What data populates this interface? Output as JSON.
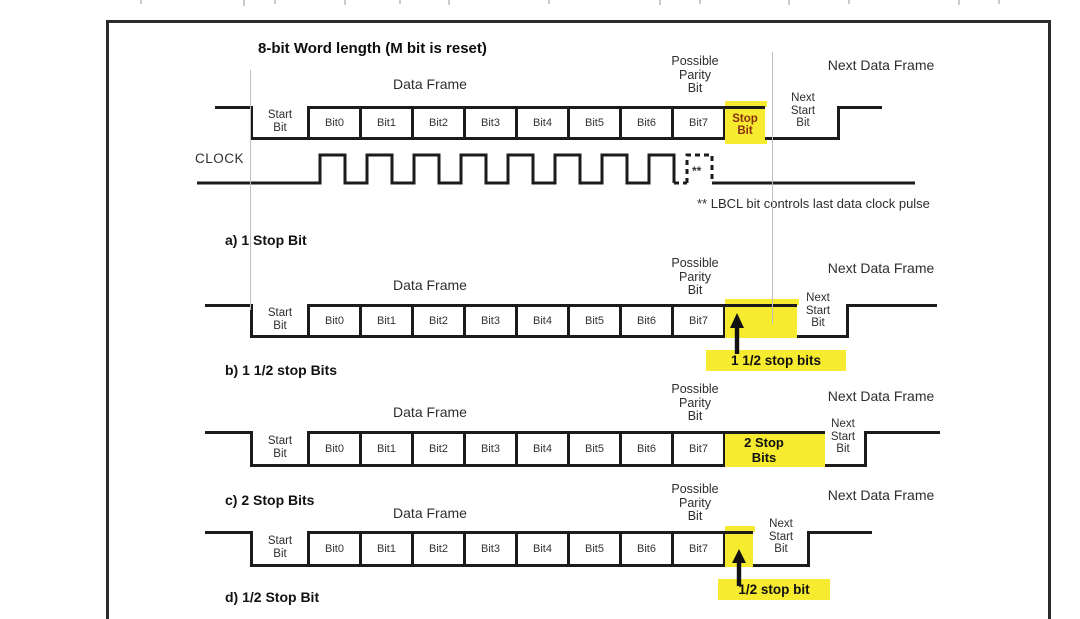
{
  "title": "8-bit Word length (M bit is reset)",
  "clock": {
    "label": "CLOCK",
    "dashed_marker": "**",
    "footnote": "** LBCL bit controls last data clock pulse"
  },
  "shared": {
    "data_frame": "Data Frame",
    "next_data_frame": "Next Data Frame",
    "possible_parity_lines": [
      "Possible",
      "Parity",
      "Bit"
    ],
    "start_bit_lines": [
      "Start",
      "Bit"
    ],
    "next_start_bit_lines": [
      "Next",
      "Start",
      "Bit"
    ],
    "bits": [
      "Bit0",
      "Bit1",
      "Bit2",
      "Bit3",
      "Bit4",
      "Bit5",
      "Bit6",
      "Bit7"
    ]
  },
  "sections": [
    {
      "id": "a",
      "stop_cell_lines": [
        "Stop",
        "Bit"
      ],
      "label_below": "a) 1 Stop Bit"
    },
    {
      "id": "b",
      "stop_caption": "1 1/2 stop bits",
      "label_below": "b) 1 1/2 stop Bits"
    },
    {
      "id": "c",
      "stop_cell_lines": [
        "2 Stop",
        "Bits"
      ],
      "label_below": "c) 2 Stop Bits"
    },
    {
      "id": "d",
      "stop_caption": "1/2 stop bit",
      "label_below": "d) 1/2 Stop Bit"
    }
  ],
  "colors": {
    "highlight": "#f6eb2e",
    "stop_bit_text": "#8b2f12",
    "line": "#1b1b1b"
  }
}
